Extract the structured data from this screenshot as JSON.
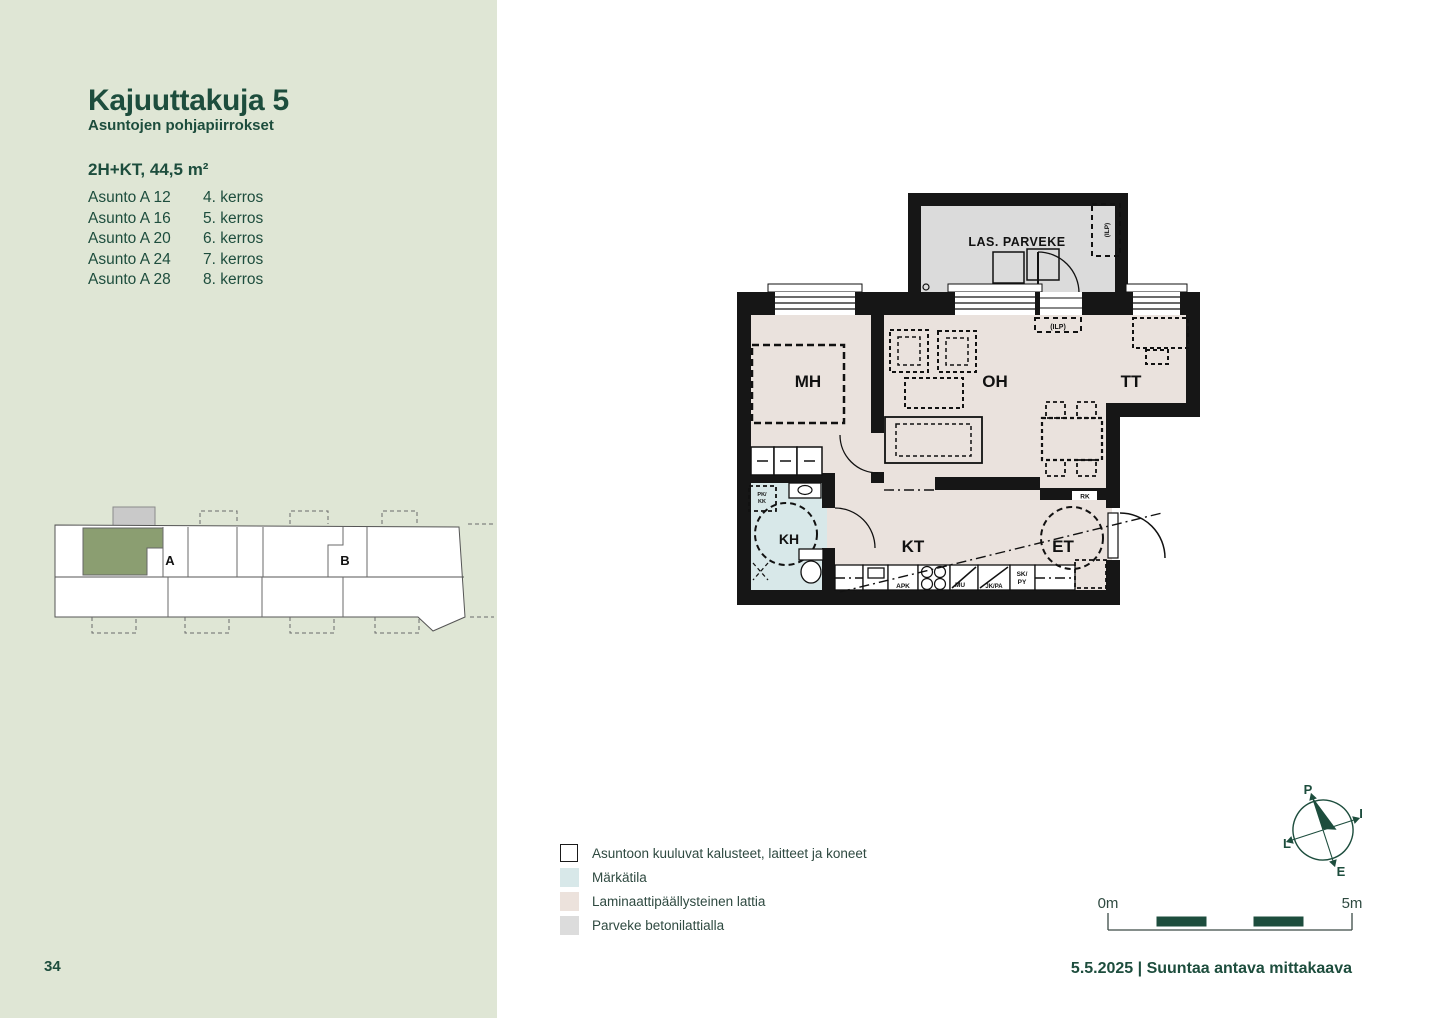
{
  "page": {
    "number": "34",
    "sidebar_bg": "#dfe6d5",
    "accent_green": "#1d4d3d"
  },
  "sidebar": {
    "title": "Kajuuttakuja 5",
    "subtitle": "Asuntojen pohjapiirrokset",
    "apartment_type": "2H+KT, 44,5 m²",
    "apartments": [
      {
        "unit": "Asunto A 12",
        "floor": "4. kerros"
      },
      {
        "unit": "Asunto A 16",
        "floor": "5. kerros"
      },
      {
        "unit": "Asunto A 20",
        "floor": "6. kerros"
      },
      {
        "unit": "Asunto A 24",
        "floor": "7. kerros"
      },
      {
        "unit": "Asunto A 28",
        "floor": "8. kerros"
      }
    ],
    "keyplan": {
      "stair_a": "A",
      "stair_b": "B",
      "highlight": "#8b9e71",
      "balcony_gray": "#c9c9c9"
    }
  },
  "floorplan": {
    "rooms": {
      "mh": "MH",
      "oh": "OH",
      "tt": "TT",
      "kt": "KT",
      "et": "ET",
      "kh": "KH"
    },
    "balcony": "LAS. PARVEKE",
    "tags": {
      "ilp_balcony": "(ILP)",
      "ilp_indoor": "(ILP)",
      "apk": "APK",
      "mu": "MU",
      "jkpa": "JK/PA",
      "sk": "SK/",
      "py": "PY",
      "rk": "RK",
      "pk": "PK/",
      "kk": "KK"
    },
    "colors": {
      "wall": "#161616",
      "laminate": "#eae2dd",
      "wet_room": "#d8e8e9",
      "balcony_floor": "#dbdbdb"
    }
  },
  "legend": {
    "items": [
      {
        "label": "Asuntoon kuuluvat kalusteet, laitteet ja koneet",
        "swatch": "#ffffff"
      },
      {
        "label": "Märkätila",
        "swatch": "#d8e8e9"
      },
      {
        "label": "Laminaattipäällysteinen lattia",
        "swatch": "#ece2dc"
      },
      {
        "label": "Parveke betonilattialla",
        "swatch": "#dcdcdc"
      }
    ]
  },
  "compass": {
    "north": "P",
    "east": "I",
    "south": "E",
    "west": "L"
  },
  "scalebar": {
    "start": "0m",
    "end": "5m"
  },
  "footer": {
    "date_scale": "5.5.2025 | Suuntaa antava mittakaava"
  }
}
